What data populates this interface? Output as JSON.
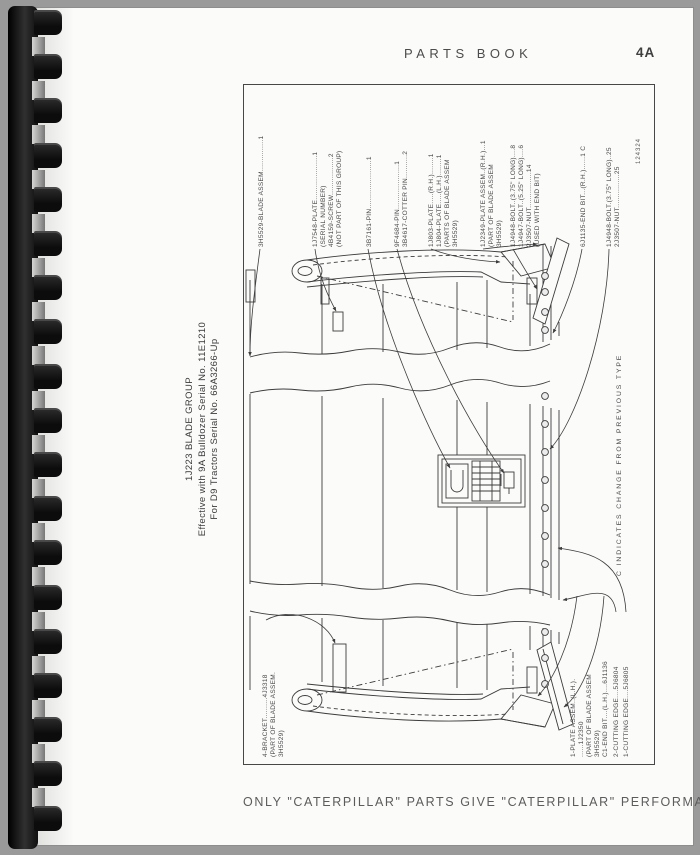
{
  "header": {
    "title": "PARTS BOOK",
    "page_number": "4A"
  },
  "figure": {
    "number": "124324",
    "title_lines": [
      "1J223 BLADE GROUP",
      "Effective with 9A Bulldozer Serial No. 11E1210",
      "For D9 Tractors Serial No. 66A3266-Up"
    ],
    "change_note": "C INDICATES CHANGE FROM PREVIOUS TYPE",
    "labels": [
      {
        "x": 258,
        "y": 247,
        "lines": [
          "3H5529-BLADE ASSEM...............1"
        ]
      },
      {
        "x": 312,
        "y": 247,
        "lines": [
          "1J7548-PLATE.....................1",
          "(SERIAL NUMBER)",
          "4B4159-SCREW..................2",
          "(NOT PART OF THIS GROUP)"
        ]
      },
      {
        "x": 366,
        "y": 247,
        "lines": [
          "3B7161-PIN.......................1"
        ]
      },
      {
        "x": 394,
        "y": 247,
        "lines": [
          "9F4684-PIN.....................1",
          "3B4617-COTTER PIN...........2"
        ]
      },
      {
        "x": 428,
        "y": 247,
        "lines": [
          "1J803-PLATE.....(R.H.)........1",
          "1J804-PLATE.....(L.H.)........1",
          "(PARTS OF BLADE ASSEM",
          "3H5529)"
        ]
      },
      {
        "x": 480,
        "y": 247,
        "lines": [
          "1J2349-PLATE ASSEM..(R.H.)...1",
          "(PART OF BLADE ASSEM",
          "3H5529)"
        ]
      },
      {
        "x": 510,
        "y": 247,
        "lines": [
          "1J4948-BOLT..(3.75\" LONG)....8",
          "1J4947-BOLT..(5.25\" LONG)....6",
          "2J3507-NUT.................14",
          "(USED WITH END BIT)"
        ]
      },
      {
        "x": 580,
        "y": 247,
        "lines": [
          "6J1135-END BIT...(R.H.)......1 C"
        ]
      },
      {
        "x": 606,
        "y": 247,
        "lines": [
          "1J4948-BOLT.(3.75\" LONG)..25",
          "2J3507-NUT................25"
        ]
      },
      {
        "x": 262,
        "y": 757,
        "lines": [
          "4-BRACKET..........4J3318",
          "(PART OF BLADE ASSEM.",
          "3H5529)"
        ]
      },
      {
        "x": 570,
        "y": 757,
        "lines": [
          "1-PLATE ASSEM..(L.H.).",
          "......1J2350",
          "(PART OF BLADE ASSEM",
          "3H5529)"
        ]
      },
      {
        "x": 602,
        "y": 757,
        "lines": [
          "C1-END BIT....(L.H.)....6J1136"
        ]
      },
      {
        "x": 613,
        "y": 757,
        "lines": [
          "2-CUTTING EDGE....5J6804"
        ]
      },
      {
        "x": 623,
        "y": 757,
        "lines": [
          "1-CUTTING EDGE....5J6805"
        ]
      }
    ]
  },
  "footer": {
    "slogan": "ONLY \"CATERPILLAR\" PARTS GIVE \"CATERPILLAR\" PERFORMANCE"
  }
}
